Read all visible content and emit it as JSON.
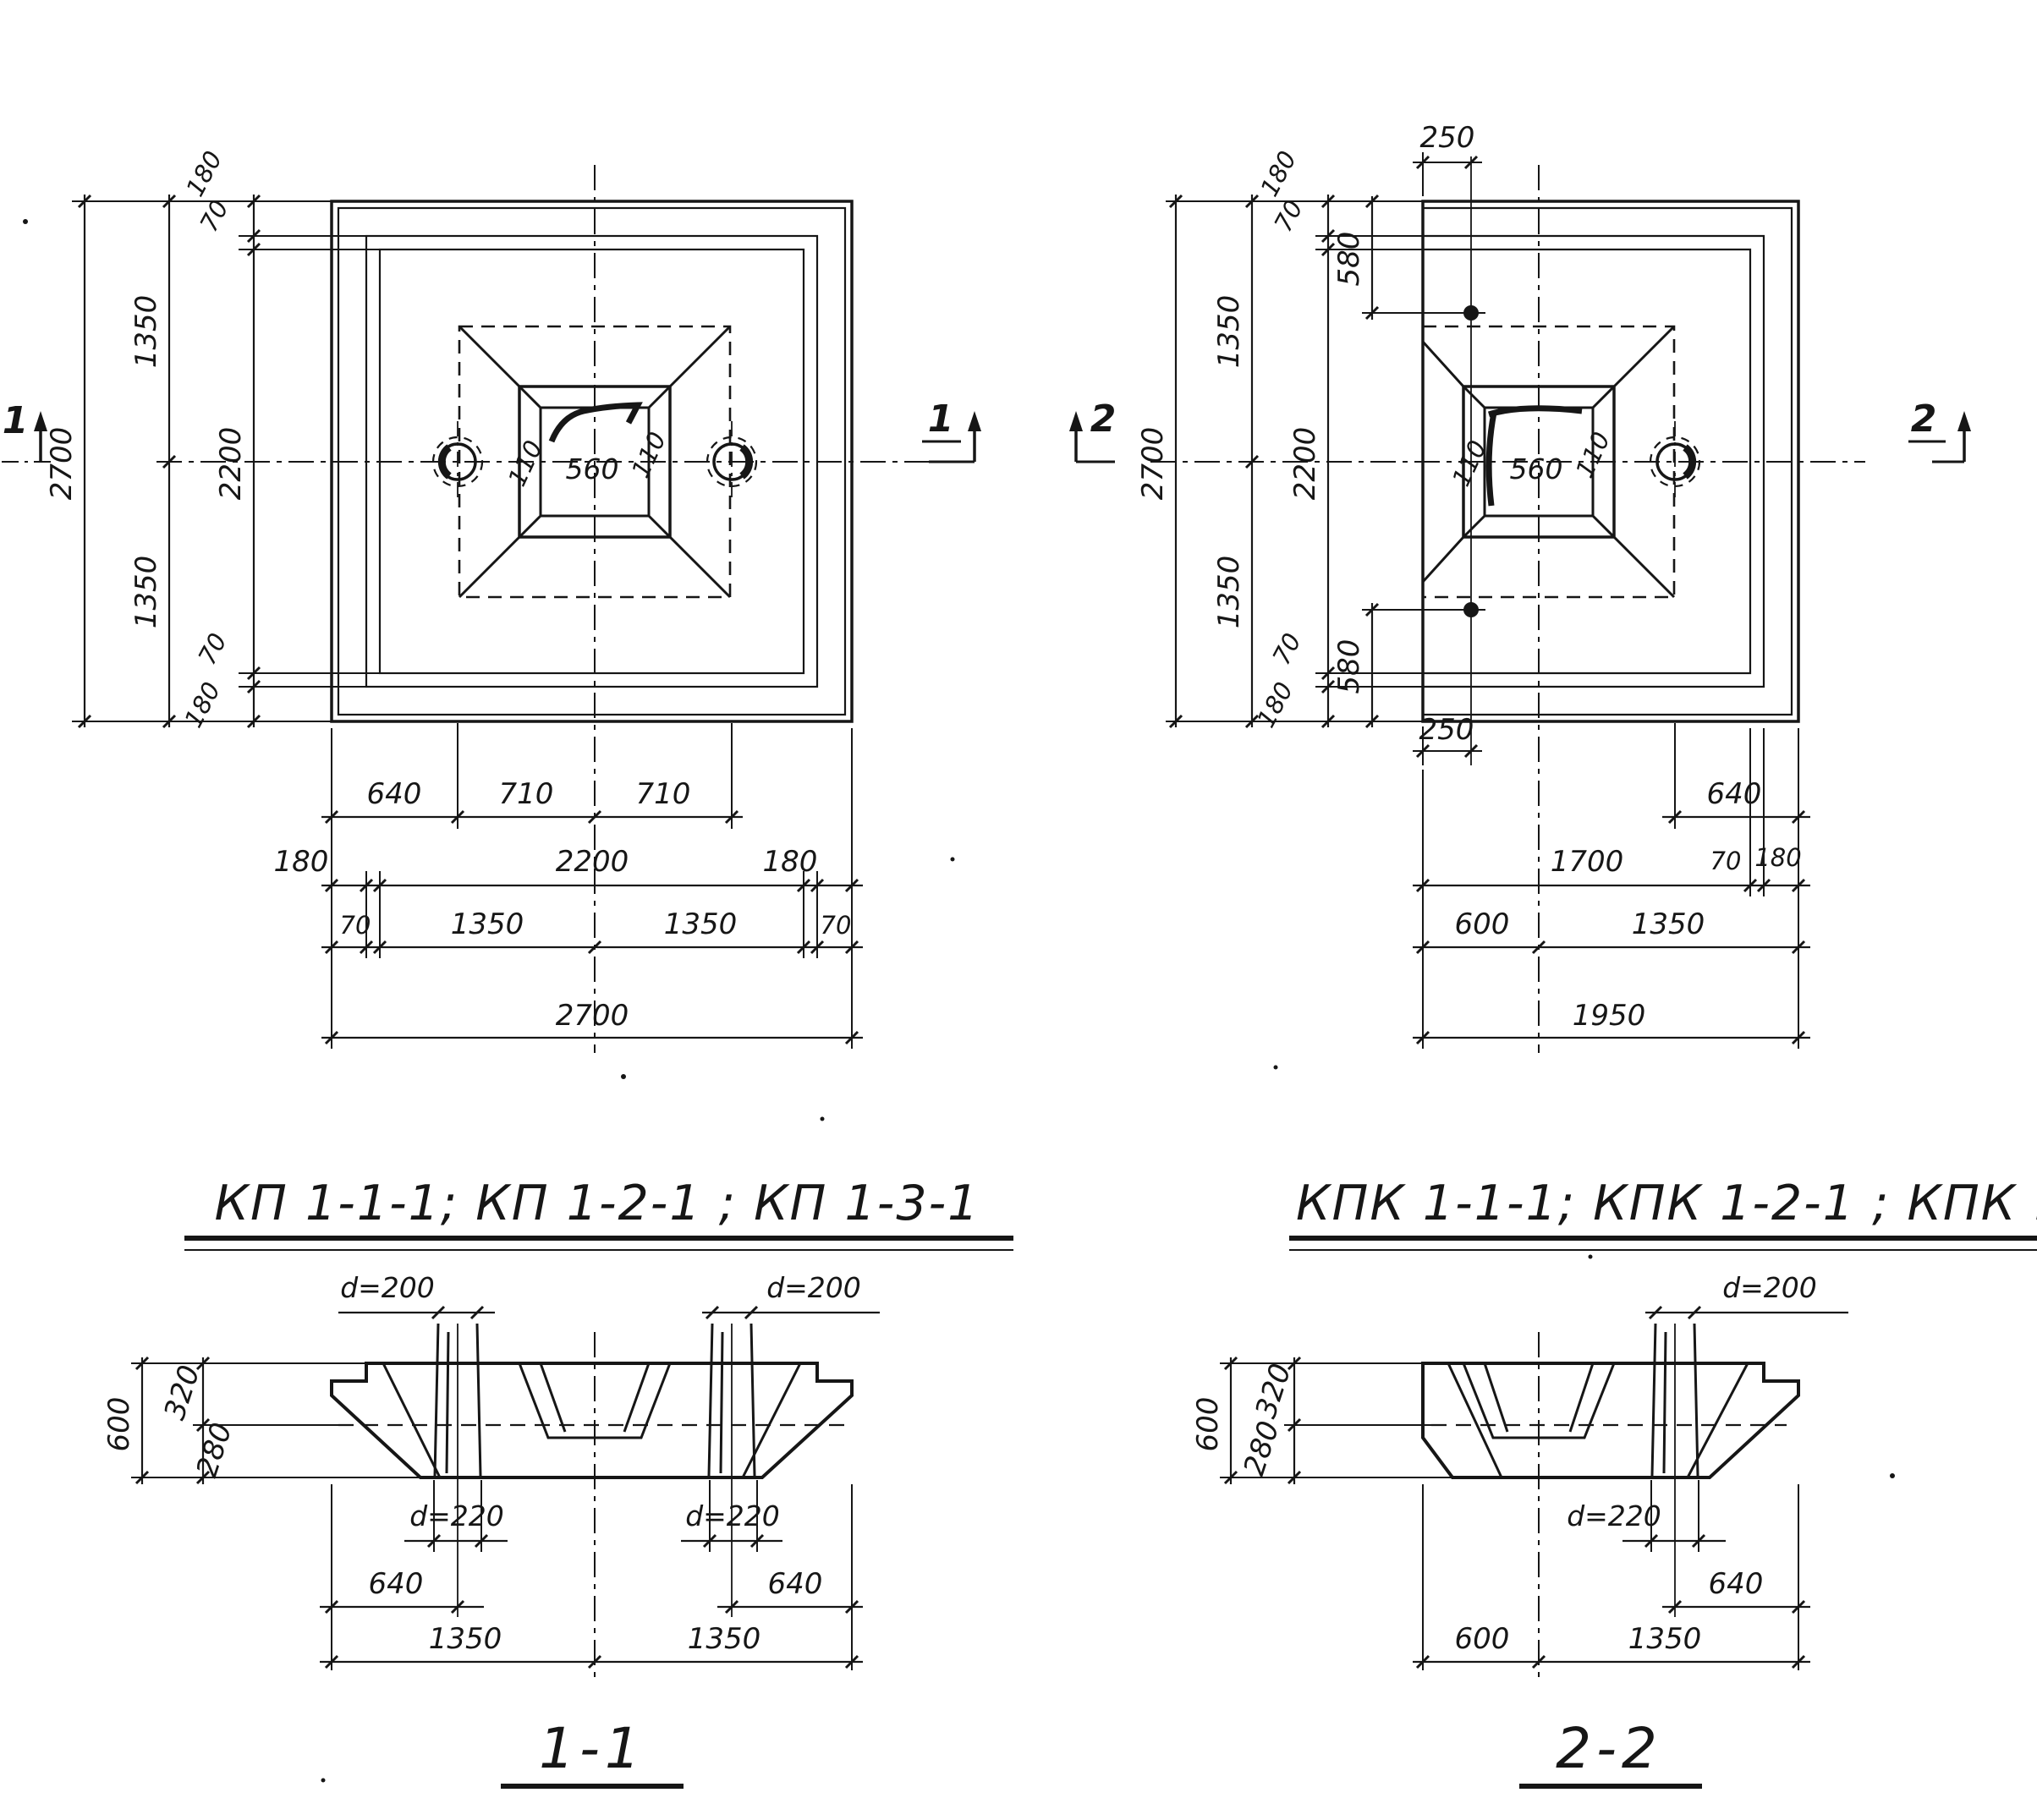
{
  "ink": "#161616",
  "background": "#ffffff",
  "plan_left": {
    "section_marks": {
      "left": "1",
      "right": "1"
    },
    "left_chain": {
      "total": "2700",
      "halves": [
        "1350",
        "1350"
      ],
      "edge": [
        "180",
        "70",
        "2200",
        "70",
        "180"
      ]
    },
    "socket": {
      "width": "560",
      "flange_left": "110",
      "flange_right": "110"
    },
    "bottom_rows": {
      "row1": [
        "640",
        "710",
        "710"
      ],
      "row2": [
        "180",
        "2200",
        "180"
      ],
      "row3": [
        "70",
        "1350",
        "1350",
        "70"
      ],
      "row4": "2700"
    }
  },
  "plan_right": {
    "section_marks": {
      "left": "2",
      "right": "2"
    },
    "top_dim": "250",
    "bottom_dim": "250",
    "left_chain": {
      "total": "2700",
      "halves": [
        "1350",
        "1350"
      ],
      "edge": [
        "180",
        "70",
        "2200",
        "70",
        "180"
      ],
      "anchor_top": "580",
      "anchor_bottom": "580"
    },
    "socket": {
      "width": "560",
      "flange_left": "110",
      "flange_right": "110"
    },
    "bottom_rows": {
      "row1": "640",
      "row2": [
        "1700",
        "70",
        "180"
      ],
      "row3": [
        "600",
        "1350"
      ],
      "row4": "1950"
    }
  },
  "titles": {
    "left": "КП 1-1-1; КП 1-2-1 ; КП 1-3-1",
    "right": "КПК 1-1-1; КПК 1-2-1 ; КПК 1-3-1"
  },
  "section_1_1": {
    "label": "1-1",
    "sleeves_top": [
      "d=200",
      "d=200"
    ],
    "sleeves_bottom": [
      "d=220",
      "d=220"
    ],
    "height_chain": [
      "600",
      "320",
      "280"
    ],
    "bottom_rows": {
      "row1": [
        "640",
        "640"
      ],
      "row2": [
        "1350",
        "1350"
      ]
    }
  },
  "section_2_2": {
    "label": "2-2",
    "sleeve_top": "d=200",
    "sleeve_bottom": "d=220",
    "height_chain": [
      "600",
      "320",
      "280"
    ],
    "bottom_rows": {
      "row1": "640",
      "row2": [
        "600",
        "1350"
      ]
    }
  }
}
